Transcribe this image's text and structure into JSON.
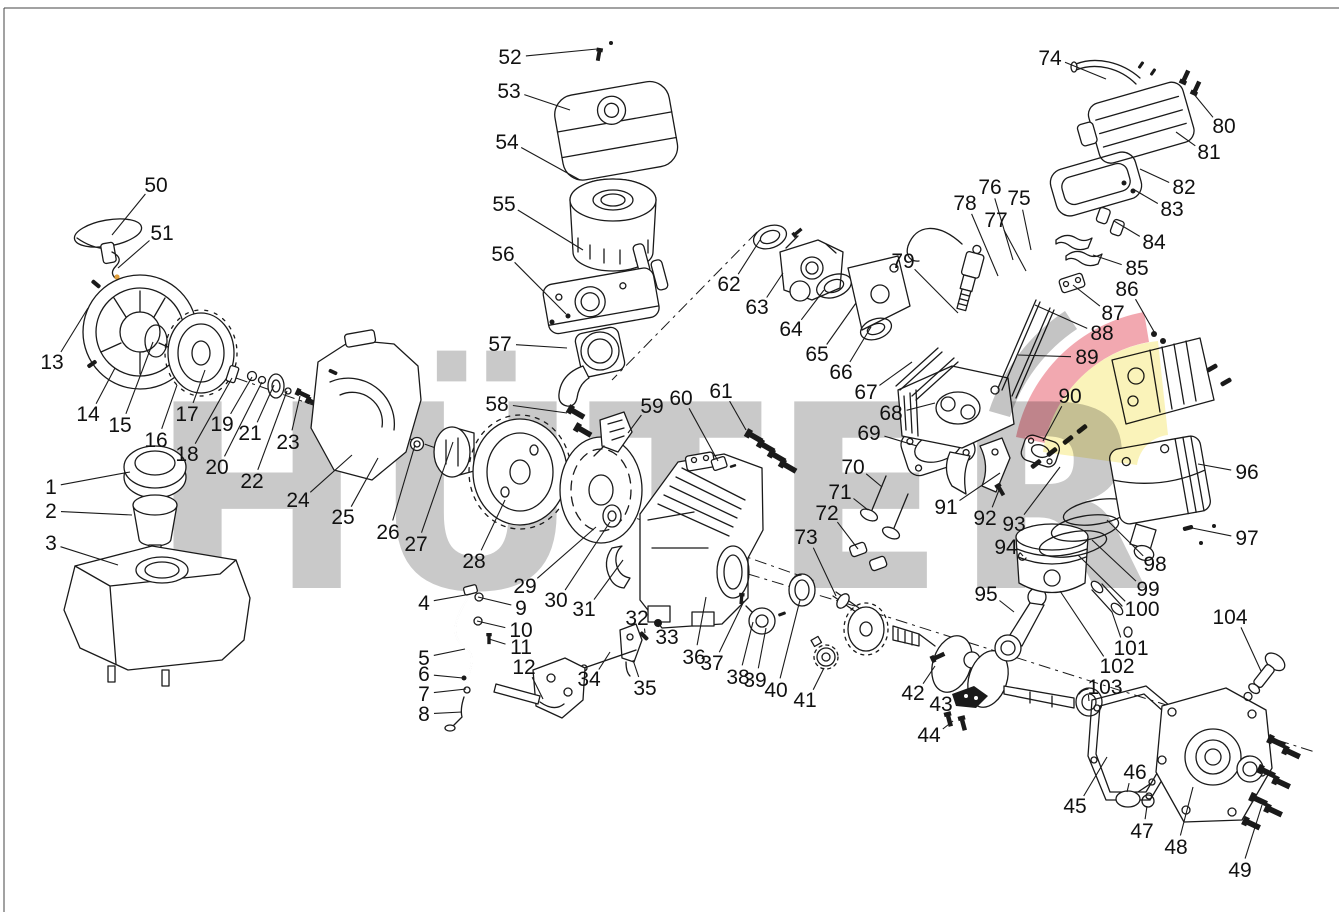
{
  "page": {
    "type": "exploded-parts-diagram",
    "subject": "engine-spare-parts-drawing"
  },
  "watermark": {
    "text": "HÜTER"
  },
  "colors": {
    "background": "#ffffff",
    "line": "#1a1a1a",
    "label": "#111111",
    "watermark_gray": "#c9c9c9",
    "swoosh_gray": "#c4c4c4",
    "swoosh_red": "#f2a8b0",
    "swoosh_yellow": "#faf3ba",
    "accent_dot": "#e2a03c",
    "border": "#444444"
  },
  "diagram": {
    "callout_first": 1,
    "callout_last": 104,
    "callout_count": 104
  },
  "callouts": [
    {
      "n": "1",
      "lx": 51,
      "ly": 487,
      "tx": 130,
      "ty": 472
    },
    {
      "n": "2",
      "lx": 51,
      "ly": 511,
      "tx": 132,
      "ty": 515
    },
    {
      "n": "3",
      "lx": 51,
      "ly": 543,
      "tx": 118,
      "ty": 565
    },
    {
      "n": "4",
      "lx": 424,
      "ly": 603,
      "tx": 471,
      "ty": 594
    },
    {
      "n": "5",
      "lx": 424,
      "ly": 658,
      "tx": 465,
      "ty": 649
    },
    {
      "n": "6",
      "lx": 424,
      "ly": 674,
      "tx": 463,
      "ty": 678
    },
    {
      "n": "7",
      "lx": 424,
      "ly": 694,
      "tx": 466,
      "ty": 689
    },
    {
      "n": "8",
      "lx": 424,
      "ly": 714,
      "tx": 462,
      "ty": 712
    },
    {
      "n": "9",
      "lx": 521,
      "ly": 608,
      "tx": 478,
      "ty": 597
    },
    {
      "n": "10",
      "lx": 521,
      "ly": 630,
      "tx": 477,
      "ty": 621
    },
    {
      "n": "11",
      "lx": 521,
      "ly": 647,
      "tx": 489,
      "ty": 639
    },
    {
      "n": "12",
      "lx": 524,
      "ly": 667,
      "tx": 543,
      "ty": 699
    },
    {
      "n": "13",
      "lx": 52,
      "ly": 362,
      "tx": 88,
      "ty": 308
    },
    {
      "n": "14",
      "lx": 88,
      "ly": 414,
      "tx": 115,
      "ty": 368
    },
    {
      "n": "15",
      "lx": 120,
      "ly": 425,
      "tx": 153,
      "ty": 342
    },
    {
      "n": "16",
      "lx": 156,
      "ly": 440,
      "tx": 177,
      "ty": 385
    },
    {
      "n": "17",
      "lx": 187,
      "ly": 414,
      "tx": 205,
      "ty": 370
    },
    {
      "n": "18",
      "lx": 187,
      "ly": 454,
      "tx": 232,
      "ty": 378
    },
    {
      "n": "19",
      "lx": 222,
      "ly": 424,
      "tx": 252,
      "ty": 377
    },
    {
      "n": "20",
      "lx": 217,
      "ly": 467,
      "tx": 262,
      "ty": 382
    },
    {
      "n": "21",
      "lx": 250,
      "ly": 433,
      "tx": 274,
      "ty": 385
    },
    {
      "n": "22",
      "lx": 252,
      "ly": 481,
      "tx": 287,
      "ty": 391
    },
    {
      "n": "23",
      "lx": 288,
      "ly": 442,
      "tx": 300,
      "ty": 396
    },
    {
      "n": "24",
      "lx": 298,
      "ly": 500,
      "tx": 352,
      "ty": 455
    },
    {
      "n": "25",
      "lx": 343,
      "ly": 517,
      "tx": 378,
      "ty": 458
    },
    {
      "n": "26",
      "lx": 388,
      "ly": 532,
      "tx": 415,
      "ty": 445
    },
    {
      "n": "27",
      "lx": 416,
      "ly": 544,
      "tx": 453,
      "ty": 442
    },
    {
      "n": "28",
      "lx": 474,
      "ly": 561,
      "tx": 505,
      "ty": 500
    },
    {
      "n": "29",
      "lx": 525,
      "ly": 586,
      "tx": 596,
      "ty": 527
    },
    {
      "n": "30",
      "lx": 556,
      "ly": 600,
      "tx": 610,
      "ty": 522
    },
    {
      "n": "31",
      "lx": 584,
      "ly": 609,
      "tx": 623,
      "ty": 560
    },
    {
      "n": "32",
      "lx": 637,
      "ly": 618,
      "tx": 645,
      "ty": 633
    },
    {
      "n": "33",
      "lx": 667,
      "ly": 637,
      "tx": 659,
      "ty": 625
    },
    {
      "n": "34",
      "lx": 589,
      "ly": 679,
      "tx": 610,
      "ty": 652
    },
    {
      "n": "35",
      "lx": 645,
      "ly": 688,
      "tx": 633,
      "ty": 660
    },
    {
      "n": "36",
      "lx": 694,
      "ly": 657,
      "tx": 706,
      "ty": 597
    },
    {
      "n": "37",
      "lx": 712,
      "ly": 663,
      "tx": 744,
      "ty": 601
    },
    {
      "n": "38",
      "lx": 738,
      "ly": 677,
      "tx": 753,
      "ty": 622
    },
    {
      "n": "39",
      "lx": 755,
      "ly": 680,
      "tx": 766,
      "ty": 628
    },
    {
      "n": "40",
      "lx": 776,
      "ly": 690,
      "tx": 800,
      "ty": 600
    },
    {
      "n": "41",
      "lx": 805,
      "ly": 700,
      "tx": 824,
      "ty": 668
    },
    {
      "n": "42",
      "lx": 913,
      "ly": 693,
      "tx": 935,
      "ty": 666
    },
    {
      "n": "43",
      "lx": 941,
      "ly": 704,
      "tx": 962,
      "ty": 700
    },
    {
      "n": "44",
      "lx": 929,
      "ly": 735,
      "tx": 953,
      "ty": 721
    },
    {
      "n": "45",
      "lx": 1075,
      "ly": 806,
      "tx": 1107,
      "ty": 757
    },
    {
      "n": "46",
      "lx": 1135,
      "ly": 772,
      "tx": 1127,
      "ty": 792
    },
    {
      "n": "47",
      "lx": 1142,
      "ly": 831,
      "tx": 1147,
      "ty": 806
    },
    {
      "n": "48",
      "lx": 1176,
      "ly": 847,
      "tx": 1193,
      "ty": 787
    },
    {
      "n": "49",
      "lx": 1240,
      "ly": 870,
      "tx": 1262,
      "ty": 805
    },
    {
      "n": "50",
      "lx": 156,
      "ly": 185,
      "tx": 112,
      "ty": 235
    },
    {
      "n": "51",
      "lx": 162,
      "ly": 233,
      "tx": 118,
      "ty": 268
    },
    {
      "n": "52",
      "lx": 510,
      "ly": 57,
      "tx": 597,
      "ty": 49
    },
    {
      "n": "53",
      "lx": 509,
      "ly": 91,
      "tx": 570,
      "ty": 110
    },
    {
      "n": "54",
      "lx": 507,
      "ly": 142,
      "tx": 580,
      "ty": 180
    },
    {
      "n": "55",
      "lx": 504,
      "ly": 204,
      "tx": 583,
      "ty": 250
    },
    {
      "n": "56",
      "lx": 503,
      "ly": 254,
      "tx": 566,
      "ty": 314
    },
    {
      "n": "57",
      "lx": 500,
      "ly": 344,
      "tx": 567,
      "ty": 348
    },
    {
      "n": "58",
      "lx": 497,
      "ly": 404,
      "tx": 567,
      "ty": 413
    },
    {
      "n": "59",
      "lx": 652,
      "ly": 406,
      "tx": 628,
      "ty": 433
    },
    {
      "n": "60",
      "lx": 681,
      "ly": 398,
      "tx": 718,
      "ty": 461
    },
    {
      "n": "61",
      "lx": 721,
      "ly": 391,
      "tx": 746,
      "ty": 430
    },
    {
      "n": "62",
      "lx": 729,
      "ly": 284,
      "tx": 760,
      "ty": 240
    },
    {
      "n": "63",
      "lx": 757,
      "ly": 307,
      "tx": 783,
      "ty": 273
    },
    {
      "n": "64",
      "lx": 791,
      "ly": 329,
      "tx": 824,
      "ty": 290
    },
    {
      "n": "65",
      "lx": 817,
      "ly": 354,
      "tx": 856,
      "ty": 303
    },
    {
      "n": "66",
      "lx": 841,
      "ly": 372,
      "tx": 871,
      "ty": 327
    },
    {
      "n": "67",
      "lx": 866,
      "ly": 392,
      "tx": 912,
      "ty": 362
    },
    {
      "n": "68",
      "lx": 891,
      "ly": 413,
      "tx": 935,
      "ty": 403
    },
    {
      "n": "69",
      "lx": 869,
      "ly": 433,
      "tx": 917,
      "ty": 446
    },
    {
      "n": "70",
      "lx": 853,
      "ly": 467,
      "tx": 882,
      "ty": 487
    },
    {
      "n": "71",
      "lx": 840,
      "ly": 492,
      "tx": 868,
      "ty": 510
    },
    {
      "n": "72",
      "lx": 827,
      "ly": 513,
      "tx": 858,
      "ty": 549
    },
    {
      "n": "73",
      "lx": 806,
      "ly": 537,
      "tx": 836,
      "ty": 596
    },
    {
      "n": "74",
      "lx": 1050,
      "ly": 58,
      "tx": 1106,
      "ty": 79
    },
    {
      "n": "75",
      "lx": 1019,
      "ly": 198,
      "tx": 1031,
      "ty": 250
    },
    {
      "n": "76",
      "lx": 990,
      "ly": 187,
      "tx": 1013,
      "ty": 260
    },
    {
      "n": "77",
      "lx": 996,
      "ly": 220,
      "tx": 1026,
      "ty": 271
    },
    {
      "n": "78",
      "lx": 965,
      "ly": 203,
      "tx": 998,
      "ty": 276
    },
    {
      "n": "79",
      "lx": 903,
      "ly": 261,
      "tx": 958,
      "ty": 313
    },
    {
      "n": "80",
      "lx": 1224,
      "ly": 126,
      "tx": 1193,
      "ty": 93
    },
    {
      "n": "81",
      "lx": 1209,
      "ly": 152,
      "tx": 1176,
      "ty": 132
    },
    {
      "n": "82",
      "lx": 1184,
      "ly": 187,
      "tx": 1140,
      "ty": 169
    },
    {
      "n": "83",
      "lx": 1172,
      "ly": 209,
      "tx": 1133,
      "ty": 189
    },
    {
      "n": "84",
      "lx": 1154,
      "ly": 242,
      "tx": 1114,
      "ty": 221
    },
    {
      "n": "85",
      "lx": 1137,
      "ly": 268,
      "tx": 1093,
      "ty": 255
    },
    {
      "n": "86",
      "lx": 1127,
      "ly": 289,
      "tx": 1156,
      "ty": 335
    },
    {
      "n": "87",
      "lx": 1113,
      "ly": 313,
      "tx": 1073,
      "ty": 285
    },
    {
      "n": "88",
      "lx": 1102,
      "ly": 333,
      "tx": 1035,
      "ty": 305
    },
    {
      "n": "89",
      "lx": 1087,
      "ly": 357,
      "tx": 1018,
      "ty": 355
    },
    {
      "n": "90",
      "lx": 1070,
      "ly": 396,
      "tx": 1043,
      "ty": 441
    },
    {
      "n": "91",
      "lx": 946,
      "ly": 507,
      "tx": 1000,
      "ty": 473
    },
    {
      "n": "92",
      "lx": 985,
      "ly": 518,
      "tx": 999,
      "ty": 490
    },
    {
      "n": "93",
      "lx": 1014,
      "ly": 524,
      "tx": 1060,
      "ty": 467
    },
    {
      "n": "94",
      "lx": 1006,
      "ly": 547,
      "tx": 1023,
      "ty": 556
    },
    {
      "n": "95",
      "lx": 986,
      "ly": 594,
      "tx": 1014,
      "ty": 612
    },
    {
      "n": "96",
      "lx": 1247,
      "ly": 472,
      "tx": 1198,
      "ty": 464
    },
    {
      "n": "97",
      "lx": 1247,
      "ly": 538,
      "tx": 1192,
      "ty": 528
    },
    {
      "n": "98",
      "lx": 1155,
      "ly": 564,
      "tx": 1107,
      "ty": 520
    },
    {
      "n": "99",
      "lx": 1148,
      "ly": 589,
      "tx": 1092,
      "ty": 540
    },
    {
      "n": "100",
      "lx": 1142,
      "ly": 609,
      "tx": 1078,
      "ty": 555
    },
    {
      "n": "101",
      "lx": 1131,
      "ly": 648,
      "tx": 1112,
      "ty": 612
    },
    {
      "n": "102",
      "lx": 1117,
      "ly": 666,
      "tx": 1060,
      "ty": 591
    },
    {
      "n": "103",
      "lx": 1105,
      "ly": 687,
      "tx": 1089,
      "ty": 701
    },
    {
      "n": "104",
      "lx": 1230,
      "ly": 617,
      "tx": 1261,
      "ty": 671
    }
  ]
}
